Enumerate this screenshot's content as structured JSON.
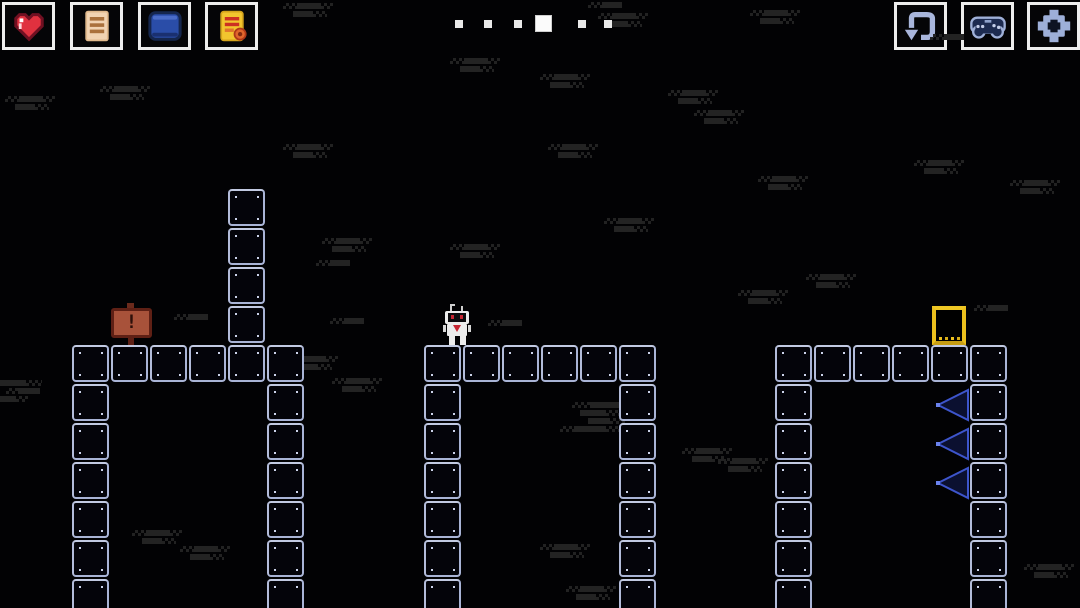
{
  "hud": {
    "left_buttons": [
      {
        "name": "health",
        "icon": "heart-icon"
      },
      {
        "name": "menu-list",
        "icon": "list-icon"
      },
      {
        "name": "journal",
        "icon": "book-icon"
      },
      {
        "name": "notes",
        "icon": "note-icon"
      }
    ],
    "right_buttons": [
      {
        "name": "restart-level",
        "icon": "restart-icon"
      },
      {
        "name": "controls",
        "icon": "gamepad-icon"
      },
      {
        "name": "settings",
        "icon": "gear-icon"
      }
    ],
    "progress": {
      "total": 6,
      "current_index": 3,
      "dot_positions": [
        455,
        484,
        514,
        535,
        578,
        604
      ]
    }
  },
  "level": {
    "block_size": 39,
    "colors": {
      "background": "#020204",
      "block_outline": "#a9b4d6",
      "block_fill": "#04040a",
      "block_dot": "#ccd3ea",
      "spike_outline": "#3d55cc",
      "spike_fill": "#0b1030",
      "spike_tip": "#6a82ee",
      "door_frame": "#ecc01d",
      "sign_border": "#5f2015",
      "sign_fill": "#a8523a",
      "heart_red": "#e0313f",
      "noise": "#232323",
      "hud_border": "#ededed"
    },
    "structures": [
      {
        "name": "left-tower",
        "x": 228,
        "y": 189,
        "cols": 1,
        "rows": 4
      },
      {
        "name": "left-platform",
        "x": 72,
        "y": 345,
        "cols": 6,
        "rows": 1
      },
      {
        "name": "left-leg-left",
        "x": 72,
        "y": 384,
        "cols": 1,
        "rows": 6
      },
      {
        "name": "left-leg-right",
        "x": 267,
        "y": 384,
        "cols": 1,
        "rows": 6
      },
      {
        "name": "mid-platform",
        "x": 424,
        "y": 345,
        "cols": 6,
        "rows": 1
      },
      {
        "name": "mid-leg-left",
        "x": 424,
        "y": 384,
        "cols": 1,
        "rows": 6
      },
      {
        "name": "mid-leg-right",
        "x": 619,
        "y": 384,
        "cols": 1,
        "rows": 6
      },
      {
        "name": "right-platform",
        "x": 775,
        "y": 345,
        "cols": 6,
        "rows": 1
      },
      {
        "name": "right-leg-left",
        "x": 775,
        "y": 384,
        "cols": 1,
        "rows": 6
      },
      {
        "name": "right-leg-right",
        "x": 970,
        "y": 384,
        "cols": 1,
        "rows": 6
      }
    ],
    "sign": {
      "x": 111,
      "y": 303,
      "label": "!"
    },
    "player": {
      "x": 441,
      "y": 304
    },
    "door": {
      "x": 932,
      "y": 306
    },
    "spikes": [
      {
        "x": 934,
        "y": 387
      },
      {
        "x": 934,
        "y": 426
      },
      {
        "x": 934,
        "y": 465
      }
    ],
    "noise": [
      [
        283,
        3,
        1
      ],
      [
        588,
        2,
        0
      ],
      [
        598,
        13,
        1
      ],
      [
        750,
        10,
        1
      ],
      [
        930,
        34,
        0
      ],
      [
        450,
        58,
        1
      ],
      [
        540,
        74,
        1
      ],
      [
        100,
        86,
        1
      ],
      [
        5,
        96,
        1
      ],
      [
        668,
        90,
        1
      ],
      [
        694,
        110,
        1
      ],
      [
        283,
        144,
        1
      ],
      [
        548,
        144,
        1
      ],
      [
        914,
        160,
        1
      ],
      [
        1010,
        180,
        1
      ],
      [
        758,
        176,
        1
      ],
      [
        604,
        218,
        1
      ],
      [
        322,
        238,
        1
      ],
      [
        450,
        244,
        1
      ],
      [
        316,
        260,
        0
      ],
      [
        806,
        274,
        1
      ],
      [
        738,
        290,
        1
      ],
      [
        174,
        314,
        0
      ],
      [
        330,
        318,
        0
      ],
      [
        488,
        320,
        0
      ],
      [
        974,
        305,
        0
      ],
      [
        288,
        356,
        1
      ],
      [
        332,
        378,
        1
      ],
      [
        560,
        402,
        3
      ],
      [
        0,
        380,
        2
      ],
      [
        682,
        448,
        1
      ],
      [
        718,
        458,
        1
      ],
      [
        132,
        530,
        1
      ],
      [
        180,
        546,
        1
      ],
      [
        540,
        544,
        1
      ],
      [
        1024,
        564,
        1
      ],
      [
        566,
        586,
        1
      ]
    ]
  }
}
